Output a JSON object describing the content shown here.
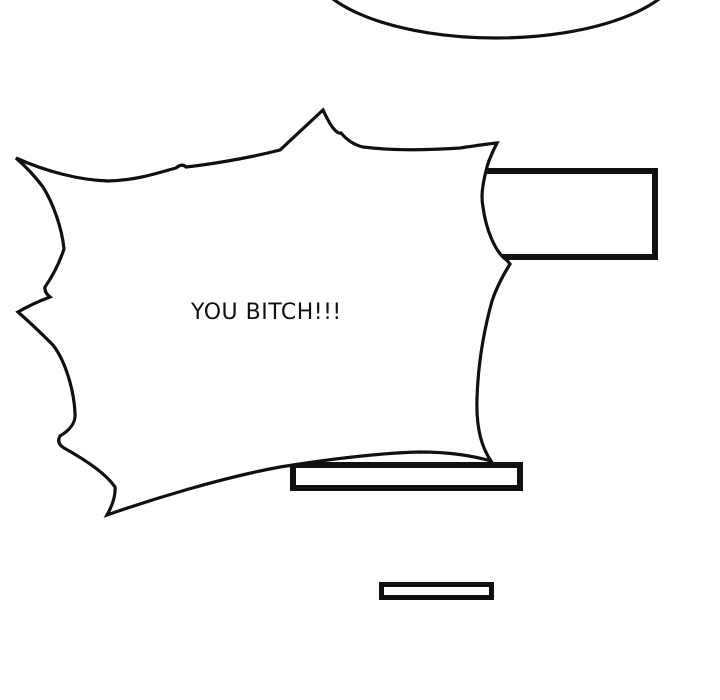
{
  "colors": {
    "background": "#ffffff",
    "ink": "#101010"
  },
  "comic": {
    "burst_bubble": {
      "text": "YOU BITCH!!!"
    }
  }
}
